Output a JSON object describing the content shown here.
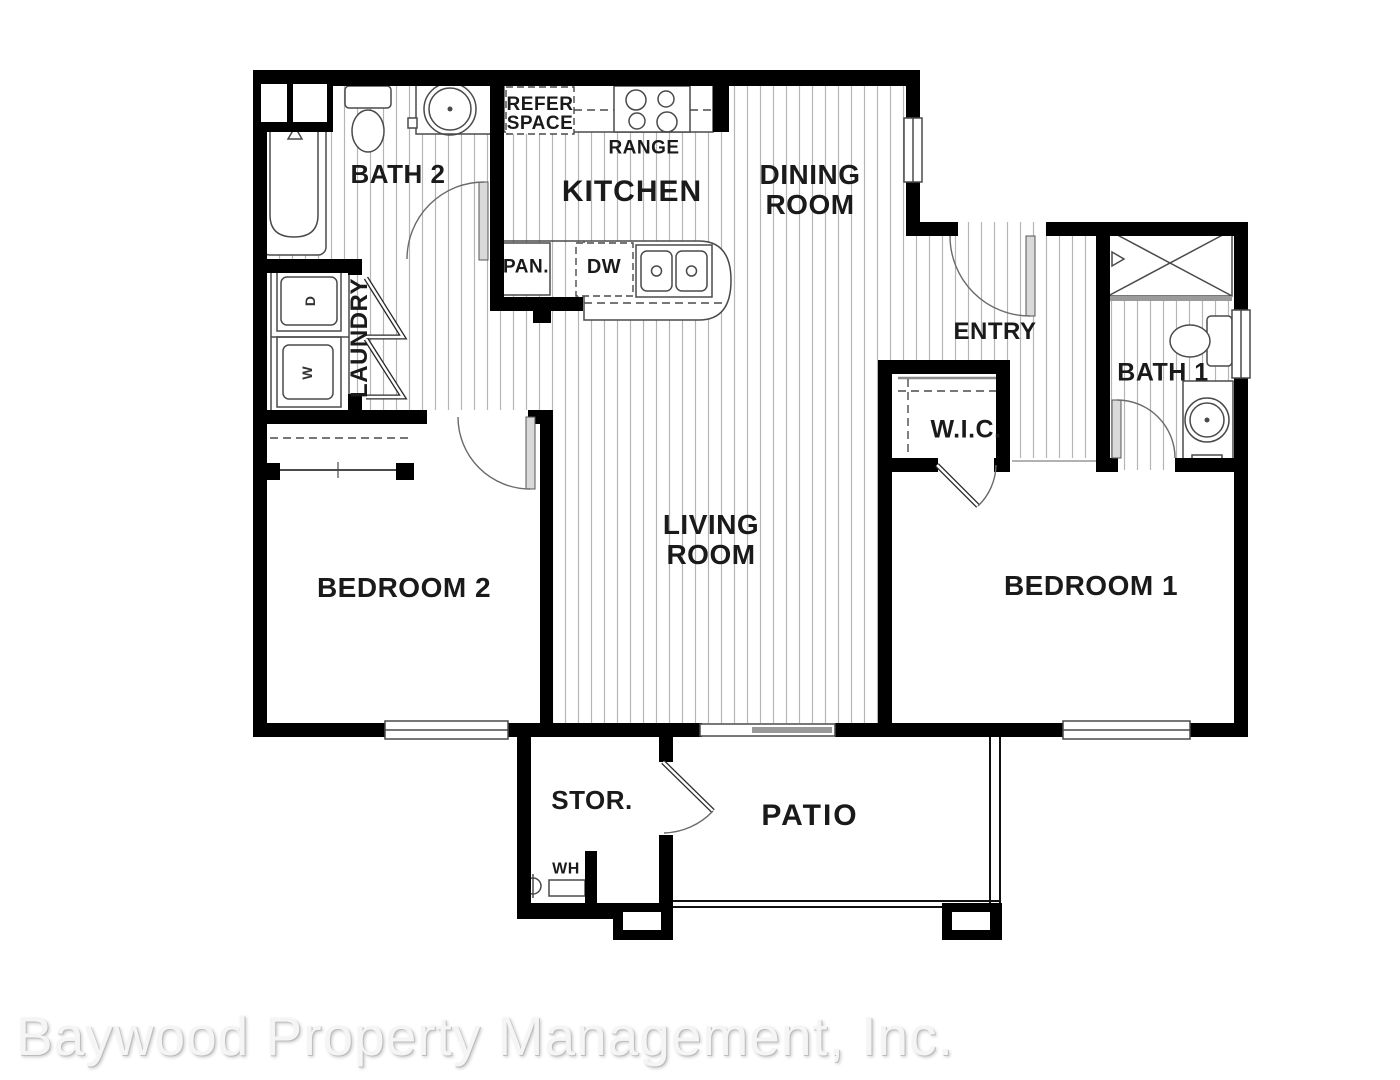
{
  "plan": {
    "rooms": {
      "bath2": "BATH 2",
      "kitchen": "KITCHEN",
      "dining": "DINING\nROOM",
      "entry": "ENTRY",
      "bath1": "BATH 1",
      "wic": "W.I.C.",
      "laundry": "LAUNDRY",
      "living": "LIVING\nROOM",
      "bedroom2": "BEDROOM 2",
      "bedroom1": "BEDROOM 1",
      "storage": "STOR.",
      "patio": "PATIO"
    },
    "fixtures": {
      "refer_space": "REFER\nSPACE",
      "range": "RANGE",
      "pantry": "PAN.",
      "dishwasher": "DW",
      "water_heater": "WH",
      "dryer": "D",
      "washer": "W"
    }
  },
  "watermark": {
    "text": "Baywood Property Management, Inc."
  },
  "colors": {
    "background": "#ffffff",
    "wall": "#000000",
    "hatch": "#b5b5b5",
    "label": "#1a1a1a",
    "fixture_line": "#4a4a4a",
    "watermark": "#f5f5f5"
  }
}
